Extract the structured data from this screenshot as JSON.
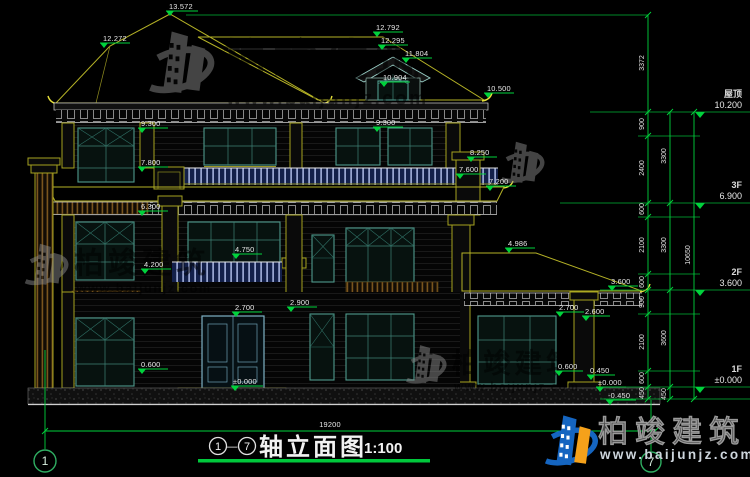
{
  "drawing": {
    "title": {
      "axis_start": "1",
      "axis_end": "7",
      "dash": "—",
      "name": "轴立面图",
      "scale": "1:100"
    },
    "levels": [
      {
        "name": "屋顶",
        "elev": "10.200"
      },
      {
        "name": "3F",
        "elev": "6.900"
      },
      {
        "name": "2F",
        "elev": "3.600"
      },
      {
        "name": "1F",
        "elev": "±0.000"
      }
    ],
    "facade_marks": [
      "13.572",
      "12.272",
      "12.792",
      "12.295",
      "11.804",
      "10.904",
      "10.500",
      "9.300",
      "9.300",
      "8.250",
      "7.800",
      "7.600",
      "7.200",
      "6.300",
      "4.986",
      "4.750",
      "4.200",
      "3.600",
      "2.900",
      "2.700",
      "2.700",
      "2.600",
      "0.600",
      "0.600",
      "0.450",
      "±0.000",
      "±0.000",
      "-0.450"
    ],
    "dim_chains": {
      "inner": [
        "3372",
        "900",
        "2400",
        "600",
        "2100",
        "600",
        "900",
        "2100",
        "600",
        "450"
      ],
      "outer": [
        "3300",
        "3300",
        "3600",
        "450"
      ],
      "total": "10650",
      "width": "19200"
    },
    "axes": {
      "left": "1",
      "right": "7"
    }
  },
  "watermark": {
    "brand": "柏竣建筑",
    "url": "www.baijunjz.com"
  },
  "colors": {
    "dim_green": "#00d23c",
    "roof_edge": "#b5b226",
    "window_teal": "#4f9a8c",
    "railing_blue": "#13204a",
    "logo_blue": "#1565c0",
    "logo_orange": "#f5a11a"
  }
}
